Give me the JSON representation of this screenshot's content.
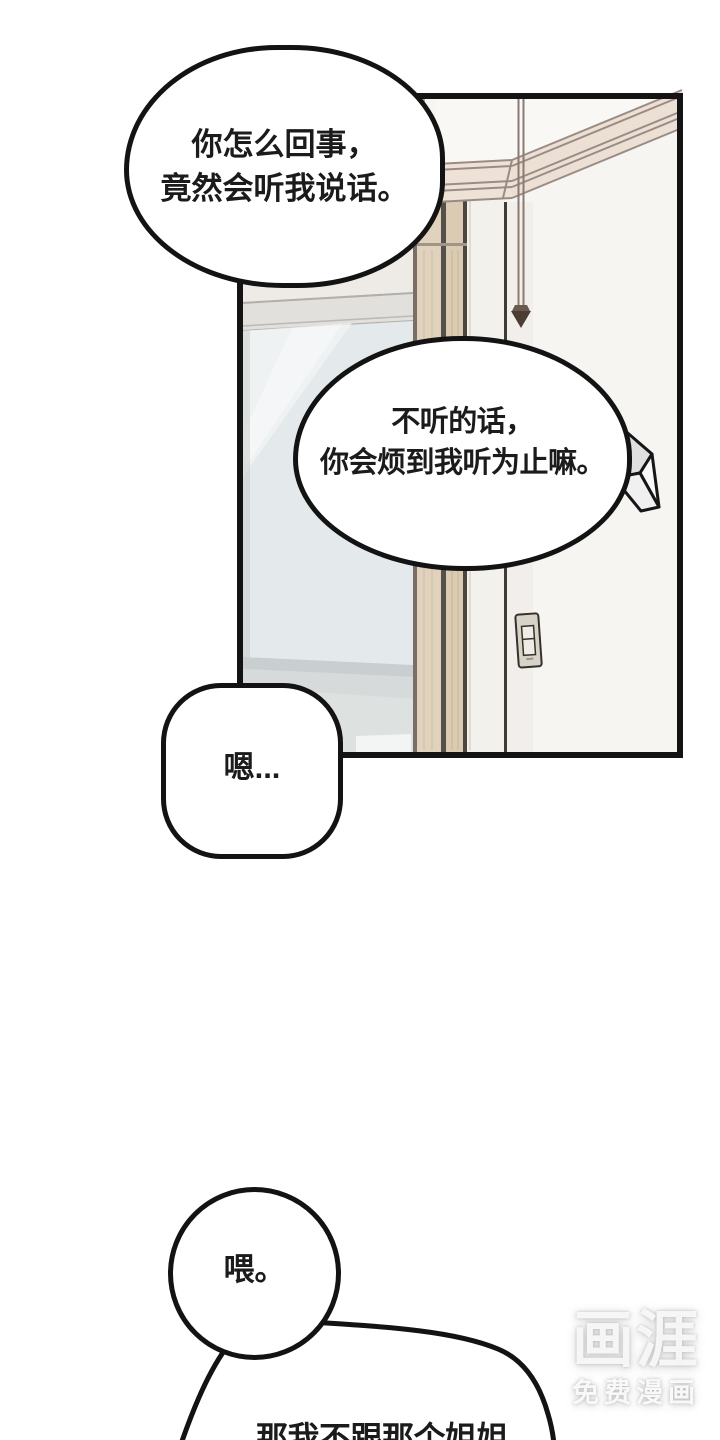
{
  "page": {
    "background": "#ffffff",
    "width": 720,
    "height": 1440
  },
  "panel": {
    "description": "room interior: glass door, wooden door frame, white wall with corner, crown molding, hanging lamp rod, light switch, folded paper shape",
    "colors": {
      "outline": "#131313",
      "wall": "#f7f5f2",
      "left_wall": "#eeebe7",
      "glass": "#e4e9eb",
      "glass_band": "#c9ced0",
      "wood_frame": "#e0d2bc",
      "wood_frame_2": "#dbcbb2",
      "molding_fill": "#ece0d5",
      "molding_line": "#9b8b85",
      "switch_plate": "#d8d3c8",
      "paper_shape": "#e0e0e0"
    }
  },
  "bubbles": [
    {
      "id": "speech-bubble-1",
      "lines": [
        "你怎么回事，",
        "竟然会听我说话。"
      ]
    },
    {
      "id": "speech-bubble-2",
      "lines": [
        "不听的话，",
        "你会烦到我听为止嘛。"
      ]
    },
    {
      "id": "speech-bubble-3",
      "lines": [
        "嗯..."
      ]
    },
    {
      "id": "speech-bubble-4",
      "lines": [
        "喂。"
      ]
    },
    {
      "id": "speech-bubble-5",
      "lines": [
        "那我不跟那个姐姐"
      ]
    }
  ],
  "watermark": {
    "logo": "画涯",
    "tagline": "免费漫画",
    "color": "#f8f8f8"
  }
}
